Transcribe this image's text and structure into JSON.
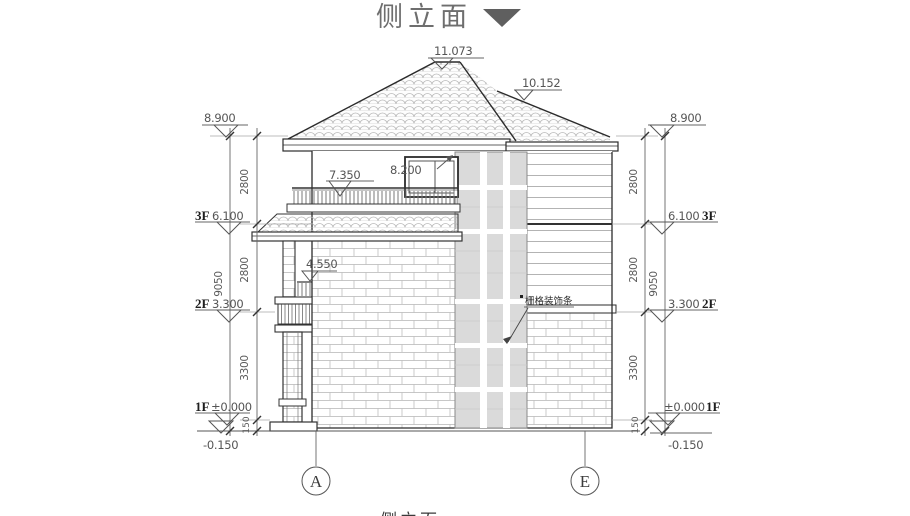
{
  "title": {
    "text": "侧立面"
  },
  "drawing": {
    "roof": {
      "main_apex": "11.073",
      "secondary_apex": "10.152"
    },
    "features": {
      "balcony_rail_level": "7.350",
      "window_level": "8.200",
      "small_rail_level": "4.550"
    },
    "callouts": {
      "grille": "栅格装饰条"
    }
  },
  "levels_left": {
    "eave": "8.900",
    "f3_label": "3F",
    "f3": "6.100",
    "f2_label": "2F",
    "f2": "3.300",
    "f1_label": "1F",
    "f1": "±0.000",
    "ground": "-0.150"
  },
  "levels_right": {
    "eave": "8.900",
    "f3_label": "3F",
    "f3": "6.100",
    "f2_label": "2F",
    "f2": "3.300",
    "f1_label": "1F",
    "f1": "±0.000",
    "ground": "-0.150"
  },
  "dims_left": {
    "floor3": "2800",
    "floor2": "2800",
    "floor1": "3300",
    "plinth": "150",
    "total": "9050"
  },
  "dims_right": {
    "floor3": "2800",
    "floor2": "2800",
    "floor1": "3300",
    "plinth": "150",
    "total": "9050"
  },
  "grid": {
    "a": "A",
    "e": "E"
  },
  "footer": {
    "caption": "侧立面"
  }
}
